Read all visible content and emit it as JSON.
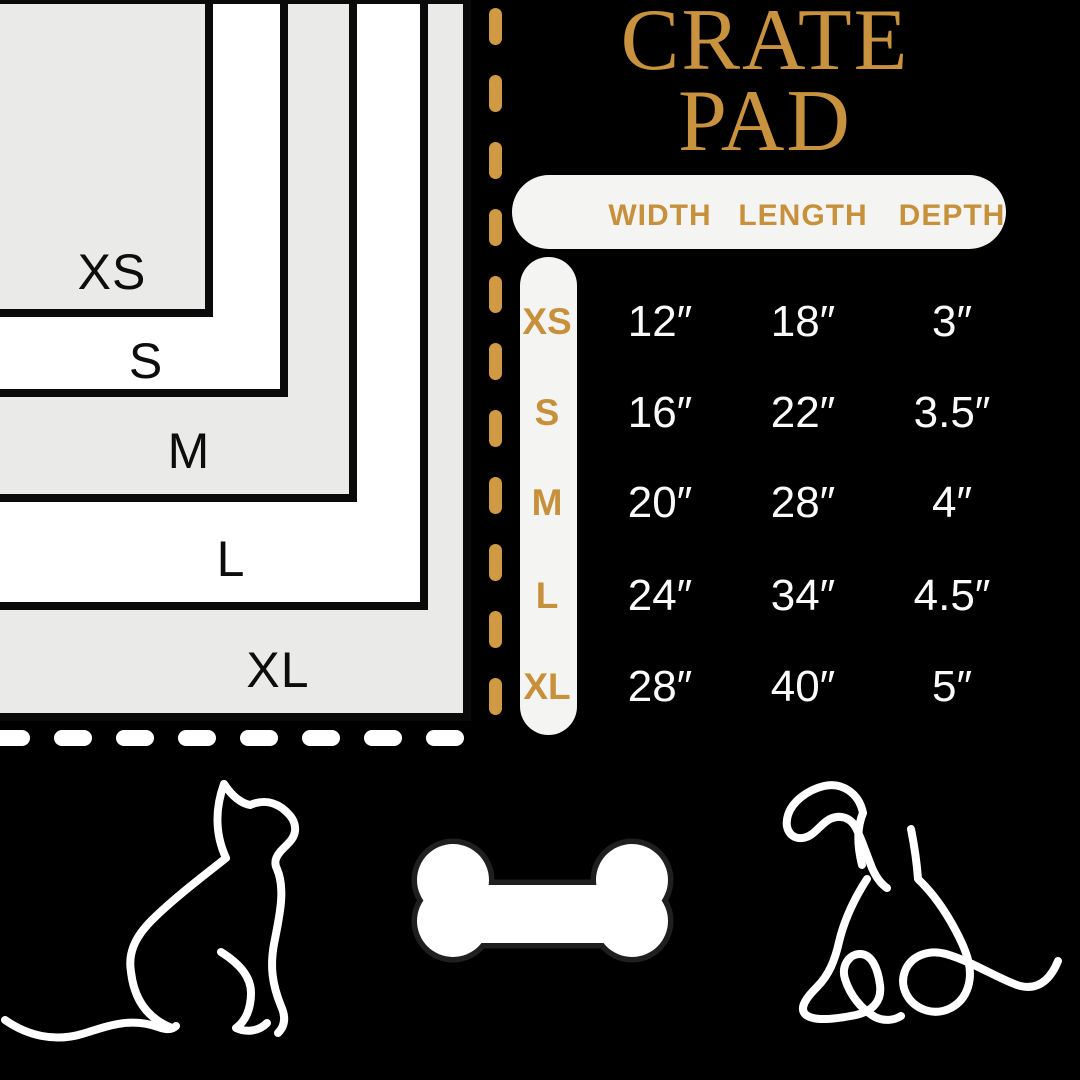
{
  "title": {
    "line1": "CRATE",
    "line2": "PAD"
  },
  "table": {
    "headers": {
      "width": "WIDTH",
      "length": "LENGTH",
      "depth": "DEPTH"
    },
    "rows": [
      {
        "size": "XS",
        "width": "12″",
        "length": "18″",
        "depth": "3″"
      },
      {
        "size": "S",
        "width": "16″",
        "length": "22″",
        "depth": "3.5″"
      },
      {
        "size": "M",
        "width": "20″",
        "length": "28″",
        "depth": "4″"
      },
      {
        "size": "L",
        "width": "24″",
        "length": "34″",
        "depth": "4.5″"
      },
      {
        "size": "XL",
        "width": "28″",
        "length": "40″",
        "depth": "5″"
      }
    ]
  },
  "diagram": {
    "labels": [
      "XS",
      "S",
      "M",
      "L",
      "XL"
    ]
  },
  "icons": {
    "left": "cat-line-icon",
    "center": "bone-icon",
    "right": "dog-line-icon"
  },
  "colors": {
    "background": "#000000",
    "gold_text": "#C8923E",
    "gold_dash": "#D09A44",
    "panel_gray": "#EAEAE8",
    "panel_white": "#FFFFFF",
    "pill_background": "#F4F4F2",
    "value_text": "#FAFAFA",
    "rect_border": "#0A0A0A"
  }
}
